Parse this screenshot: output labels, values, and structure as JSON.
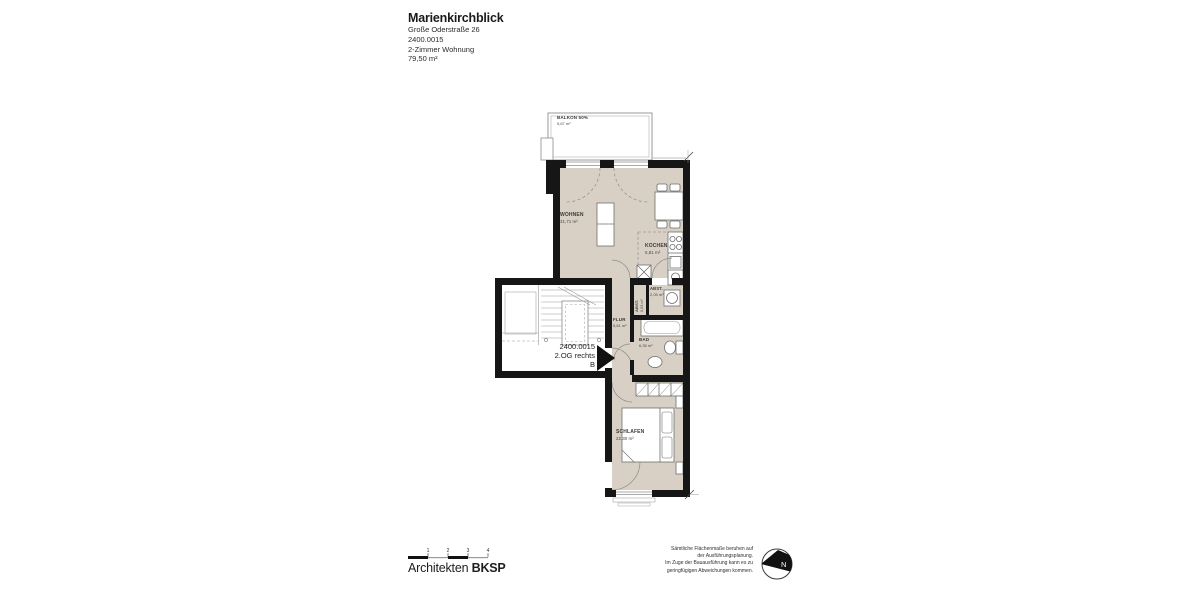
{
  "header": {
    "project_title": "Marienkirchblick",
    "address": "Große Oderstraße 26",
    "unit_id": "2400.0015",
    "apartment_type": "2-Zimmer Wohnung",
    "total_area": "79,50 m²"
  },
  "plan": {
    "rooms": [
      {
        "name": "BALKON 50%",
        "area": "5,67 m²"
      },
      {
        "name": "WOHNEN",
        "area": "31,71 m²"
      },
      {
        "name": "KOCHEN",
        "area": "5,81 m²"
      },
      {
        "name": "ABST.",
        "area": "2,05 m²"
      },
      {
        "name": "ABST.",
        "area": "0,93 m²"
      },
      {
        "name": "FLUR",
        "area": "5,61 m²"
      },
      {
        "name": "BAD",
        "area": "6,35 m²"
      },
      {
        "name": "SCHLAFEN",
        "area": "22,30 m²"
      }
    ],
    "unit_marker": {
      "line1": "2400.0015",
      "line2": "2.OG rechts",
      "line3": "B"
    }
  },
  "footer": {
    "scale_ticks": [
      "1",
      "2",
      "3",
      "4"
    ],
    "firm_name": "Architekten",
    "firm_abbr": "BKSP",
    "disclaimer_lines": [
      "Sämtliche Flächenmaße beruhen auf",
      "der Ausführungsplanung.",
      "Im Zuge der Bauausführung kann es zu",
      "geringfügigen Abweichungen kommen."
    ],
    "north_label": "N"
  },
  "colors": {
    "floor_fill": "#d8d0c4",
    "wall": "#161616",
    "thin_line": "#8c8c8c"
  }
}
